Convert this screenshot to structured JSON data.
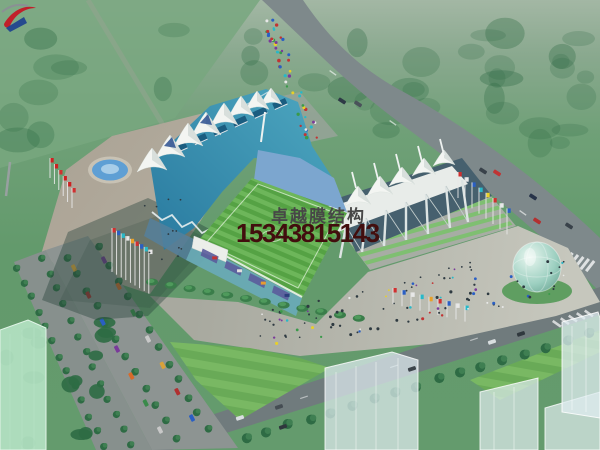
{
  "watermark": {
    "company": "卓越膜结构",
    "phone": "15343815143"
  },
  "palette": {
    "tree-dark": "#2e6b44",
    "tree-mid": "#3f7f52",
    "road": "#7e898b",
    "road-dark": "#707b7d",
    "plaza": "#aba395",
    "plaza-light": "#c2c1b6",
    "roof-teal": "#3d95b2",
    "roof-teal-dark": "#25688c",
    "tent-white": "#f3f5f2",
    "tent-shade": "#c9d2d0",
    "seat-blue": "#7ca6cf",
    "pitch": "#55a244",
    "pitch-light": "#6db65a",
    "facade-teal": "#69aab6",
    "facade-purple": "#5b5b9b",
    "banner-navy": "#2c3f7d",
    "water": "#5f9fd4",
    "egg": "#9ccfc0",
    "ghost": "#dfecf0",
    "glass-green": "#b5e3c4",
    "lawn": "#69aa57",
    "company-gray": "#474747",
    "phone-red": "#420e0e",
    "logo-red": "#c0202a",
    "logo-blue": "#1c3f8f"
  }
}
